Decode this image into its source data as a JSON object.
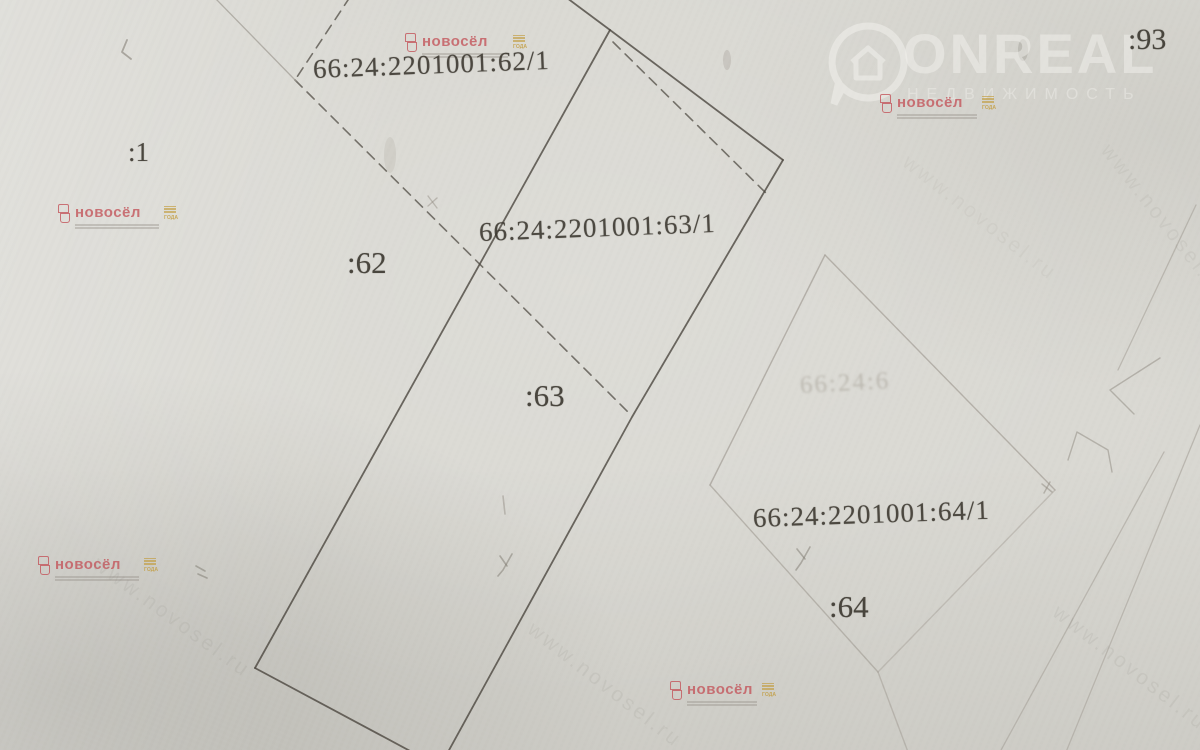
{
  "map": {
    "parcel_labels": [
      {
        "id": "62/1",
        "text": "66:24:2201001:62/1"
      },
      {
        "id": "63/1",
        "text": "66:24:2201001:63/1"
      },
      {
        "id": "64/1",
        "text": "66:24:2201001:64/1"
      }
    ],
    "point_labels": [
      {
        "id": "1",
        "text": ":1"
      },
      {
        "id": "62",
        "text": ":62"
      },
      {
        "id": "63",
        "text": ":63"
      },
      {
        "id": "64",
        "text": ":64"
      },
      {
        "id": "93",
        "text": ":93"
      }
    ],
    "faint_label": "66:24:6",
    "shapes": [
      {
        "name": "parcel-63-apex-extension",
        "pts": "567,-2 610,30",
        "c": "#4b463f",
        "w": 1.8,
        "o": 0.8
      },
      {
        "name": "parcel-63-top-edge",
        "pts": "610,30 783,160",
        "c": "#4b463f",
        "w": 1.8,
        "o": 0.8
      },
      {
        "name": "parcel-63-right-edge",
        "pts": "783,160 632,417 448,752",
        "c": "#4b463f",
        "w": 1.8,
        "o": 0.8
      },
      {
        "name": "parcel-63-left-edge",
        "pts": "610,30 255,668",
        "c": "#4b463f",
        "w": 1.8,
        "o": 0.8
      },
      {
        "name": "parcel-63-bottom-edge",
        "pts": "255,668 412,752",
        "c": "#4b463f",
        "w": 1.8,
        "o": 0.8
      },
      {
        "name": "subparcel-63-1-dashed-edge",
        "pts": "613,42 770,197",
        "c": "#4b463f",
        "w": 1.6,
        "o": 0.72,
        "d": "10 7"
      },
      {
        "name": "subparcel-62-1-dashed-notch",
        "pts": "350,-3 295,80",
        "c": "#4b463f",
        "w": 1.6,
        "o": 0.72,
        "d": "10 7"
      },
      {
        "name": "subparcel-62-1-dashed-diagonal",
        "pts": "295,80 630,414",
        "c": "#4b463f",
        "w": 1.6,
        "o": 0.72,
        "d": "10 7"
      },
      {
        "name": "parcel-62-faint-boundary",
        "pts": "215,-2 296,81",
        "c": "#9e9a92",
        "w": 1.3,
        "o": 0.7
      },
      {
        "name": "parcel-64-topleft-edge",
        "pts": "825,255 710,485",
        "c": "#a7a29a",
        "w": 1.4,
        "o": 0.75
      },
      {
        "name": "parcel-64-topright-edge",
        "pts": "825,255 1055,490",
        "c": "#a7a29a",
        "w": 1.4,
        "o": 0.75
      },
      {
        "name": "parcel-64-bottomright-edge",
        "pts": "1055,490 878,672",
        "c": "#a7a29a",
        "w": 1.4,
        "o": 0.5
      },
      {
        "name": "parcel-64-bottomleft-edge",
        "pts": "710,485 878,672",
        "c": "#a7a29a",
        "w": 1.4,
        "o": 0.7
      },
      {
        "name": "parcel-64-south-extension",
        "pts": "878,672 908,752",
        "c": "#a7a29a",
        "w": 1.4,
        "o": 0.6
      },
      {
        "name": "road-line-upper",
        "pts": "1196,205 1118,370",
        "c": "#a7a29a",
        "w": 1.3,
        "o": 0.6
      },
      {
        "name": "road-line-left",
        "pts": "1164,452 1000,752",
        "c": "#a7a29a",
        "w": 1.3,
        "o": 0.6
      },
      {
        "name": "road-line-right",
        "pts": "1200,425 1066,752",
        "c": "#a7a29a",
        "w": 1.3,
        "o": 0.6
      },
      {
        "name": "boundary-hook-upper",
        "pts": "1160,358 1110,390 1134,414",
        "c": "#a39e96",
        "w": 1.4,
        "o": 0.7
      },
      {
        "name": "boundary-hook-lower",
        "pts": "1068,460 1077,432 1108,450 1112,472",
        "c": "#a39e96",
        "w": 1.4,
        "o": 0.7
      },
      {
        "name": "pencil-tick-topleft",
        "pts": "127,40 122,52 131,59",
        "c": "#7c776d",
        "w": 1.8,
        "o": 0.55
      },
      {
        "name": "pencil-mark-a1",
        "pts": "196,566 205,571",
        "c": "#7c776d",
        "w": 1.6,
        "o": 0.5
      },
      {
        "name": "pencil-mark-a2",
        "pts": "198,574 207,578",
        "c": "#7c776d",
        "w": 1.6,
        "o": 0.5
      },
      {
        "name": "pencil-mark-one",
        "pts": "503,496 505,514",
        "c": "#8d887e",
        "w": 1.6,
        "o": 0.45
      },
      {
        "name": "pencil-mark-y1a",
        "pts": "500,556 507,566",
        "c": "#7c776d",
        "w": 1.6,
        "o": 0.5
      },
      {
        "name": "pencil-mark-y1b",
        "pts": "512,554 503,570 498,576",
        "c": "#7c776d",
        "w": 1.6,
        "o": 0.5
      },
      {
        "name": "pencil-mark-y2a",
        "pts": "797,549 805,559",
        "c": "#7c776d",
        "w": 1.6,
        "o": 0.5
      },
      {
        "name": "pencil-mark-y2b",
        "pts": "810,547 801,563 796,570",
        "c": "#7c776d",
        "w": 1.6,
        "o": 0.5
      },
      {
        "name": "pencil-mark-x1a",
        "pts": "1042,484 1052,492",
        "c": "#8d887e",
        "w": 1.5,
        "o": 0.5
      },
      {
        "name": "pencil-mark-x1b",
        "pts": "1050,482 1044,493",
        "c": "#8d887e",
        "w": 1.5,
        "o": 0.5
      },
      {
        "name": "pencil-mark-x2a",
        "pts": "428,196 437,208",
        "c": "#8d887e",
        "w": 1.4,
        "o": 0.45
      },
      {
        "name": "pencil-mark-x2b",
        "pts": "437,198 428,206",
        "c": "#8d887e",
        "w": 1.4,
        "o": 0.45
      },
      {
        "name": "smudge-top-right",
        "e": true,
        "cx": 1023,
        "cy": 50,
        "rx": 5,
        "ry": 11,
        "c": "#8d897f",
        "o": 0.32
      },
      {
        "name": "smudge-top-center",
        "e": true,
        "cx": 727,
        "cy": 60,
        "rx": 4,
        "ry": 10,
        "c": "#9a958b",
        "o": 0.28
      },
      {
        "name": "smudge-mid",
        "e": true,
        "cx": 390,
        "cy": 155,
        "rx": 6,
        "ry": 18,
        "c": "#b0aca3",
        "o": 0.25
      }
    ]
  },
  "watermarks": {
    "onreal": {
      "brand": "ONREAL",
      "subtitle": "НЕДВИЖИМОСТЬ"
    },
    "novosel": {
      "brand": "новосёл",
      "badge": "ГОДА"
    },
    "url": "www.novosel.ru"
  },
  "colors": {
    "paper": "#d9d8d2",
    "line_dark": "#4b463f",
    "line_faint": "#a7a29a",
    "label_ink": "#39352d",
    "novosel_red": "#c4565c",
    "novosel_gold": "#c29b3a",
    "onreal_white": "#f4f3ef"
  }
}
